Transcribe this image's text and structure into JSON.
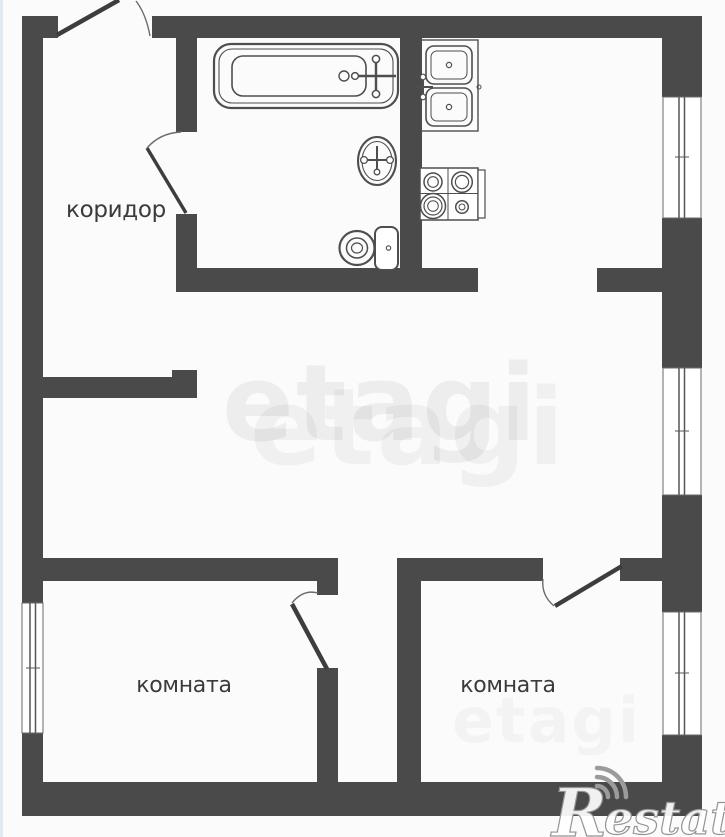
{
  "plan": {
    "type": "apartment-floor-plan",
    "labels": {
      "corridor": "коридор",
      "room_left": "комната",
      "room_right": "комната"
    },
    "fixtures": [
      "bathtub-icon",
      "washbasin-icon",
      "toilet-icon",
      "kitchen-sink-icon",
      "stove-icon"
    ],
    "openings": {
      "windows": 4,
      "doors": 5
    },
    "watermarks": {
      "center_primary": "etagi",
      "center_echo": "etagi",
      "corner_faint": "etagi",
      "brand_initial": "R",
      "brand_rest": "estate"
    },
    "colors": {
      "wall": "#4a4a4a",
      "fixture_line": "#4e4e4e",
      "label_text": "#3b3b3b",
      "watermark_gray": "#ececec",
      "brand_gray": "#9b9b9b",
      "edge_strip": "#dfe7ee",
      "background": "#fbfbfc"
    }
  }
}
